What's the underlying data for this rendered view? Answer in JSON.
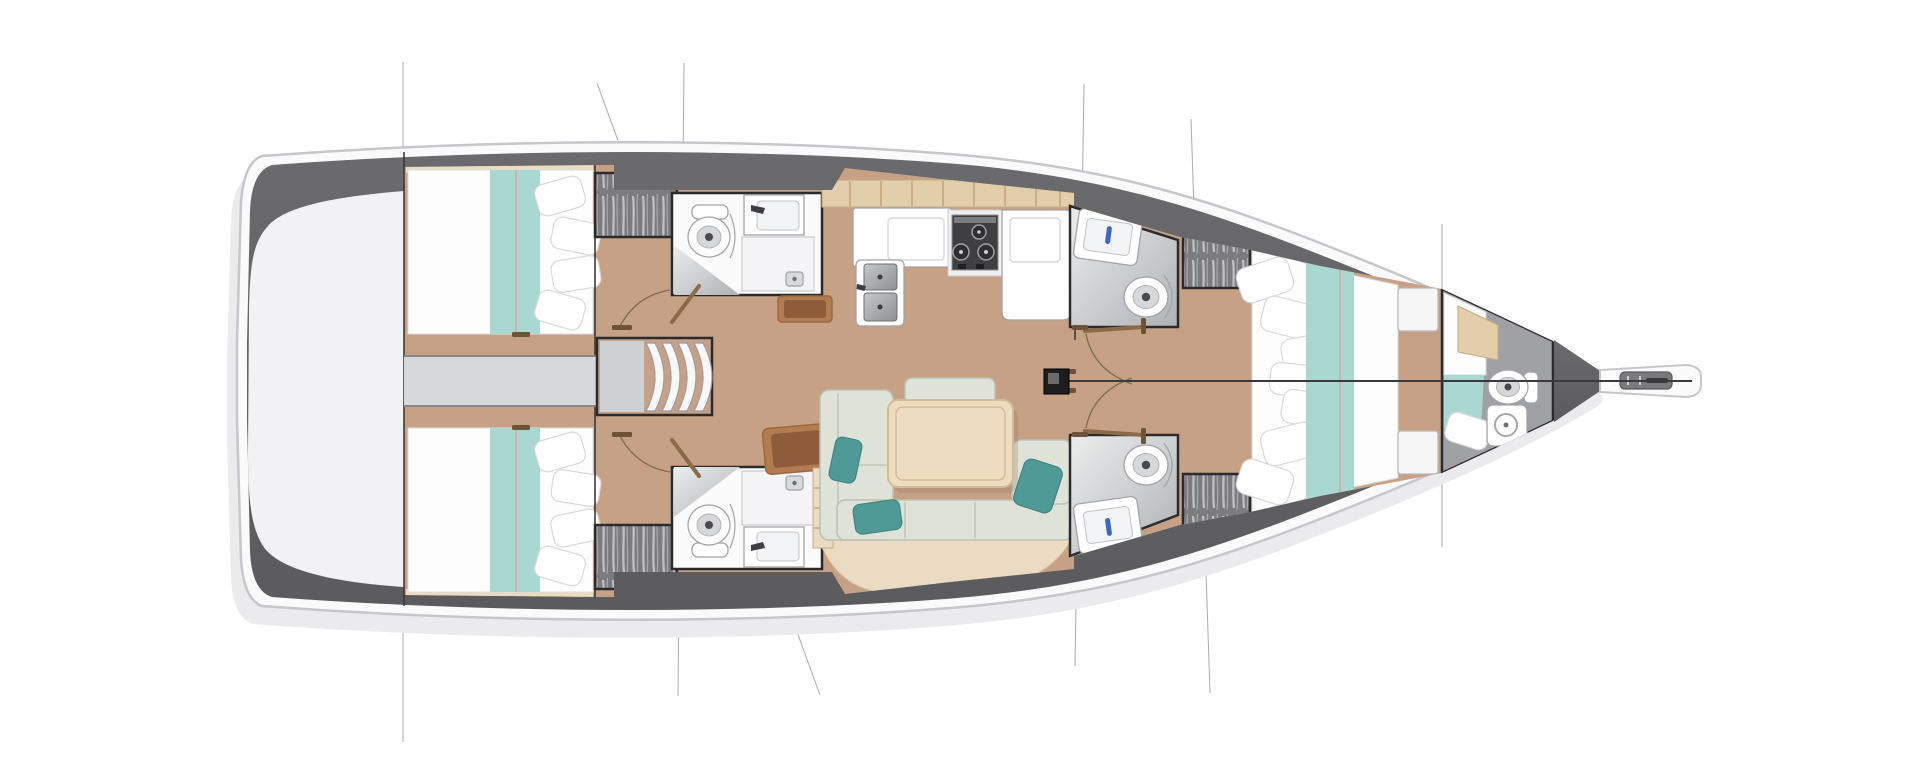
{
  "meta": {
    "title": "Sailing yacht interior layout — overhead deck floor plan",
    "view": "top-down",
    "bow_direction": "right",
    "visible_text": ""
  },
  "colors": {
    "background": "#ffffff",
    "hull_fill": "#fafafb",
    "hull_outline": "#c7c7cb",
    "hull_band": "#646467",
    "deck_white": "#f2f2f4",
    "shadow": "#ebebee",
    "floor_wood": "#c7a185",
    "floor_seam": "#b08a66",
    "bed_frame_wood": "#eadbc2",
    "locker_wood": "#e3ceac",
    "bedding_white": "#fdfdfe",
    "bedding_teal": "#a9d8d3",
    "runner_seam": "#d4a49b",
    "corridor_gray": "#d7d8da",
    "stairs_landing": "#cfd0d3",
    "sofa_sage": "#dee2d8",
    "sofa_border": "#bcc1b2",
    "pillow_teal": "#4f9a97",
    "table_wood": "#eedcc1",
    "table_border": "#d3bb98",
    "desk_brown": "#b27c50",
    "desk_inner": "#8e5c3a",
    "room_border": "#2b2b2e",
    "bath_light": "#eceded",
    "bath_dark": "#b0b1b5",
    "fixture_line": "#a3a4a8",
    "wardrobe_gray": "#7c7c80",
    "wardrobe_streak": "#cfcfd3",
    "stove_dark": "#3f3f42",
    "steel_light": "#c6c7ca",
    "steel_dark": "#8f9094",
    "centerline": "#3a3a3d",
    "rig_line": "#ababaf",
    "mast": "#1e1e21",
    "faucet_blue": "#3c66c4",
    "door_wood": "#8a6a48",
    "door_tick": "#6e5338"
  },
  "rooms": [
    {
      "name": "stern-deck"
    },
    {
      "name": "aft-cabin-port"
    },
    {
      "name": "aft-cabin-starboard"
    },
    {
      "name": "aft-head-port"
    },
    {
      "name": "aft-head-starboard"
    },
    {
      "name": "companionway"
    },
    {
      "name": "galley"
    },
    {
      "name": "salon"
    },
    {
      "name": "mid-head-port"
    },
    {
      "name": "mid-head-starboard"
    },
    {
      "name": "forward-cabin"
    },
    {
      "name": "bow-cabin-with-head"
    }
  ],
  "fixtures": [
    "double-berth",
    "pillows",
    "teal-runner",
    "hanging-locker",
    "toilet",
    "sink",
    "shower-drain",
    "stove-3-burner",
    "double-steel-sink",
    "fridge-counter",
    "chart-desk",
    "u-sofa",
    "salon-table",
    "companionway-steps",
    "mast",
    "door-swing",
    "bowsprit-anchor-roller",
    "rig-section-lines",
    "centerline"
  ]
}
